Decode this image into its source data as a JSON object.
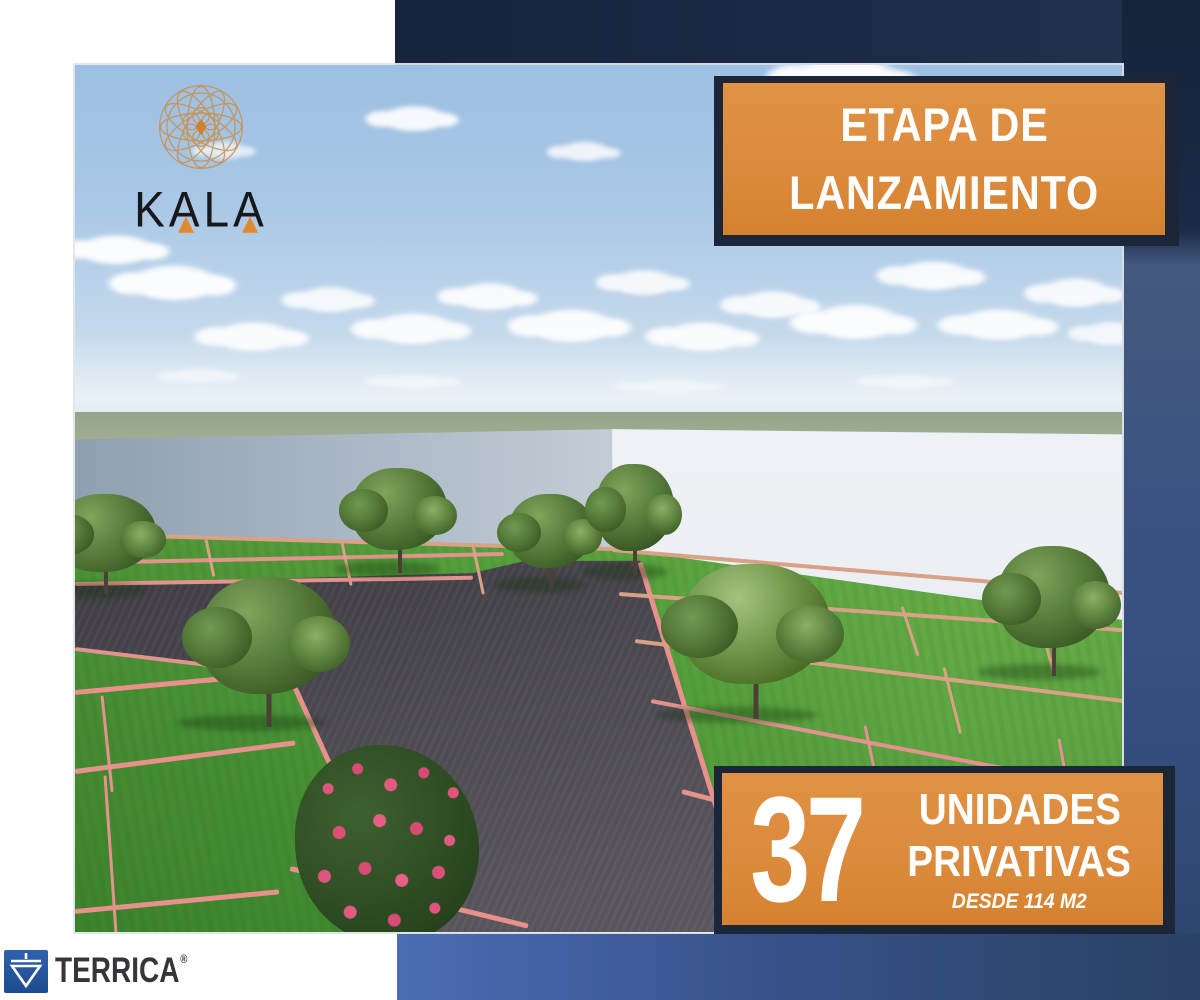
{
  "brand": {
    "name": "KALA"
  },
  "banners": {
    "launch": {
      "line1": "ETAPA DE",
      "line2": "LANZAMIENTO"
    },
    "units": {
      "number": "37",
      "line1": "UNIDADES",
      "line2": "PRIVATIVAS",
      "detail": "DESDE 114 M2"
    }
  },
  "footer": {
    "company": "TERRICA",
    "mark": "®"
  },
  "scene": {
    "description": "3D architectural render of a walled land development: green grass lots outlined with pink boundary lines, a dark gravel access road, scattered trees, a pink flowering bush in the foreground, a white perimeter wall and a light blue sky with scattered cumulus clouds.",
    "elements": [
      "sky",
      "clouds",
      "horizon field",
      "white perimeter wall",
      "grass lots",
      "pink lot lines",
      "gravel road",
      "trees",
      "flowering bush"
    ]
  },
  "colors": {
    "banner_orange": "#DC8B3E",
    "banner_text": "#FFFFFF",
    "plate_navy": "#1B2638",
    "background_navy_dark": "#17263F",
    "background_blue_mid": "#3A5282",
    "background_blue_bottom_left": "#4C6CB4",
    "kala_gold": "#C9914F",
    "kala_letters": "#17171C",
    "kala_accent_orange": "#E2892E",
    "terrica_blue": "#2A5AA4",
    "terrica_text": "#35353A",
    "sky_blue": "#A9C8E6",
    "grass_green": "#4D9839",
    "wall_white": "#ECF0F4",
    "road_gray": "#3E3C42",
    "lot_line_pink": "#E2938D"
  }
}
